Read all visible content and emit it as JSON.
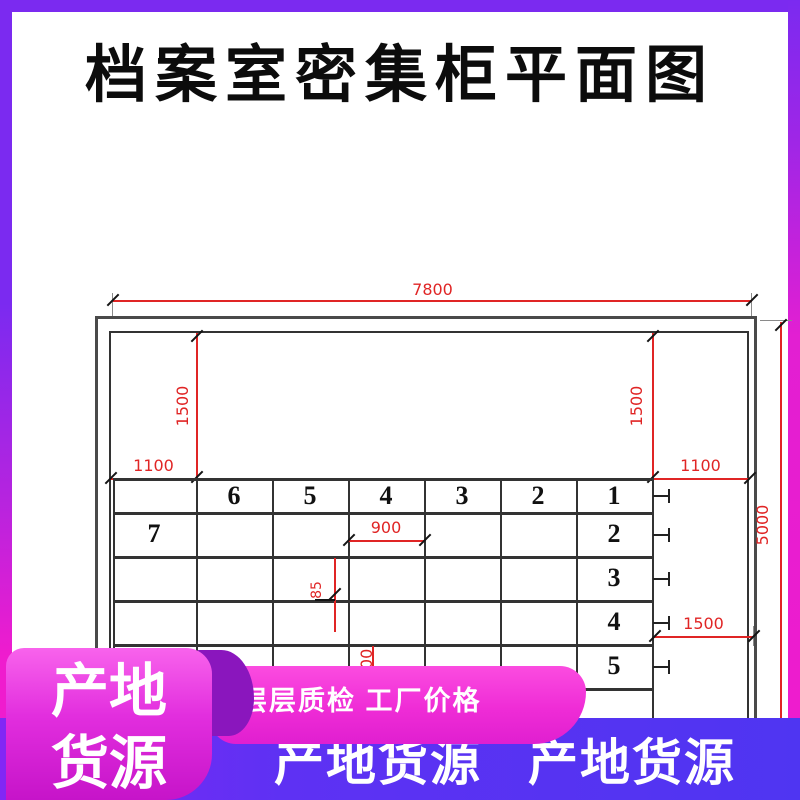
{
  "title": "档案室密集柜平面图",
  "plan": {
    "dim_width_top": "7800",
    "dim_height_right": "5000",
    "dim_inset_left_v": "1500",
    "dim_inset_right_v": "1500",
    "dim_inset_left_h": "1100",
    "dim_inset_right_h": "1100",
    "dim_aisle": "900",
    "dim_gap": "85",
    "dim_aisle_bottom": "900",
    "dim_clearance_right": "1500",
    "header_labels": [
      "6",
      "5",
      "4",
      "3",
      "2",
      "1"
    ],
    "left_unit_label": "7",
    "right_row_labels": [
      "2",
      "3",
      "4",
      "5"
    ]
  },
  "banners": {
    "ribbon_line1": "产地",
    "ribbon_line2": "货源",
    "pill_text": "层层质检 工厂价格",
    "bar_text_1": "产地货源",
    "bar_text_2": "产地货源"
  },
  "colors": {
    "dim_red": "#e02525",
    "line_dark": "#333333",
    "frame_violet": "#7b2af0",
    "frame_magenta": "#ee1ccf",
    "ribbon_pink": "#e22ede",
    "fold_purple": "#8a16bd",
    "pill_pink": "#ef2cd6",
    "bar_indigo": "#5433f1"
  }
}
